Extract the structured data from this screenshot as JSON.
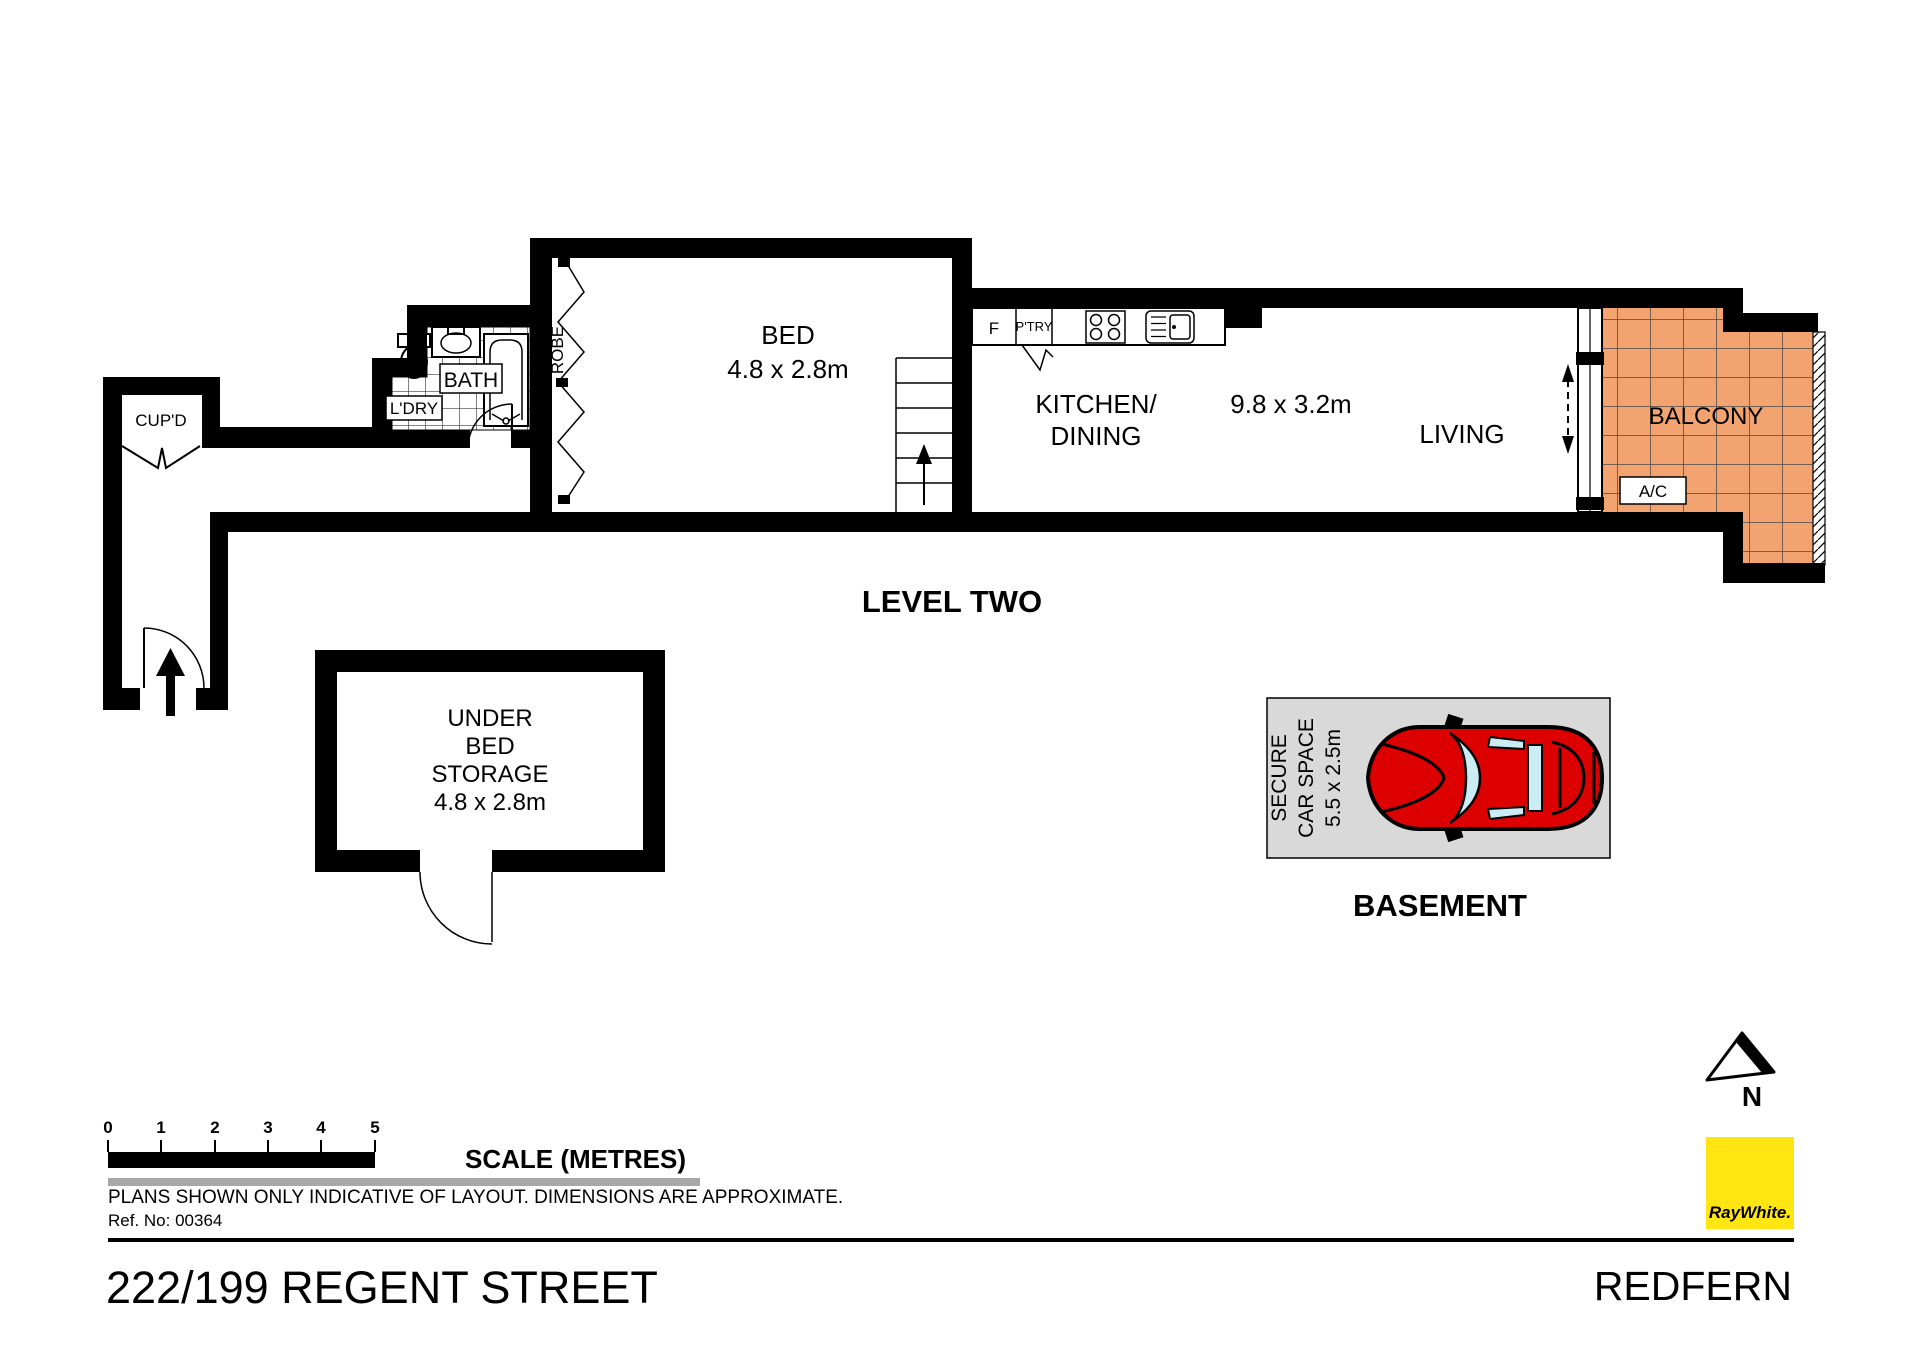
{
  "plan": {
    "level_label": "LEVEL TWO",
    "rooms": {
      "cupd": "CUP'D",
      "ldry": "L'DRY",
      "bath": "BATH",
      "robe": "ROBE",
      "bed": {
        "name": "BED",
        "dim": "4.8 x 2.8m"
      },
      "kitchen": {
        "line1": "KITCHEN/",
        "line2": "DINING",
        "dim": "9.8 x 3.2m"
      },
      "living": "LIVING",
      "balcony": "BALCONY",
      "ac": "A/C",
      "fridge": "F",
      "pantry": "P'TRY"
    },
    "storage": {
      "lines": [
        "UNDER",
        "BED",
        "STORAGE",
        "4.8 x 2.8m"
      ]
    },
    "basement": {
      "label": "BASEMENT",
      "car_space": {
        "lines": [
          "SECURE",
          "CAR SPACE",
          "5.5 x 2.5m"
        ]
      }
    }
  },
  "scale_bar": {
    "ticks": [
      "0",
      "1",
      "2",
      "3",
      "4",
      "5"
    ],
    "label": "SCALE (METRES)"
  },
  "disclaimer": "PLANS SHOWN ONLY INDICATIVE OF LAYOUT.  DIMENSIONS ARE APPROXIMATE.",
  "ref_no": "Ref. No: 00364",
  "footer": {
    "address": "222/199 REGENT STREET",
    "suburb": "REDFERN"
  },
  "branding": {
    "logo_text": "RayWhite."
  },
  "compass": {
    "label": "N"
  },
  "colors": {
    "balcony_tile": "#F2A36F",
    "carspace_bg": "#D9D9D9",
    "car_body": "#DD0000",
    "car_glass": "#C9ECF5",
    "logo_bg": "#FFE512",
    "logo_fg": "#58595B",
    "gray_bar": "#A8A8A8"
  }
}
